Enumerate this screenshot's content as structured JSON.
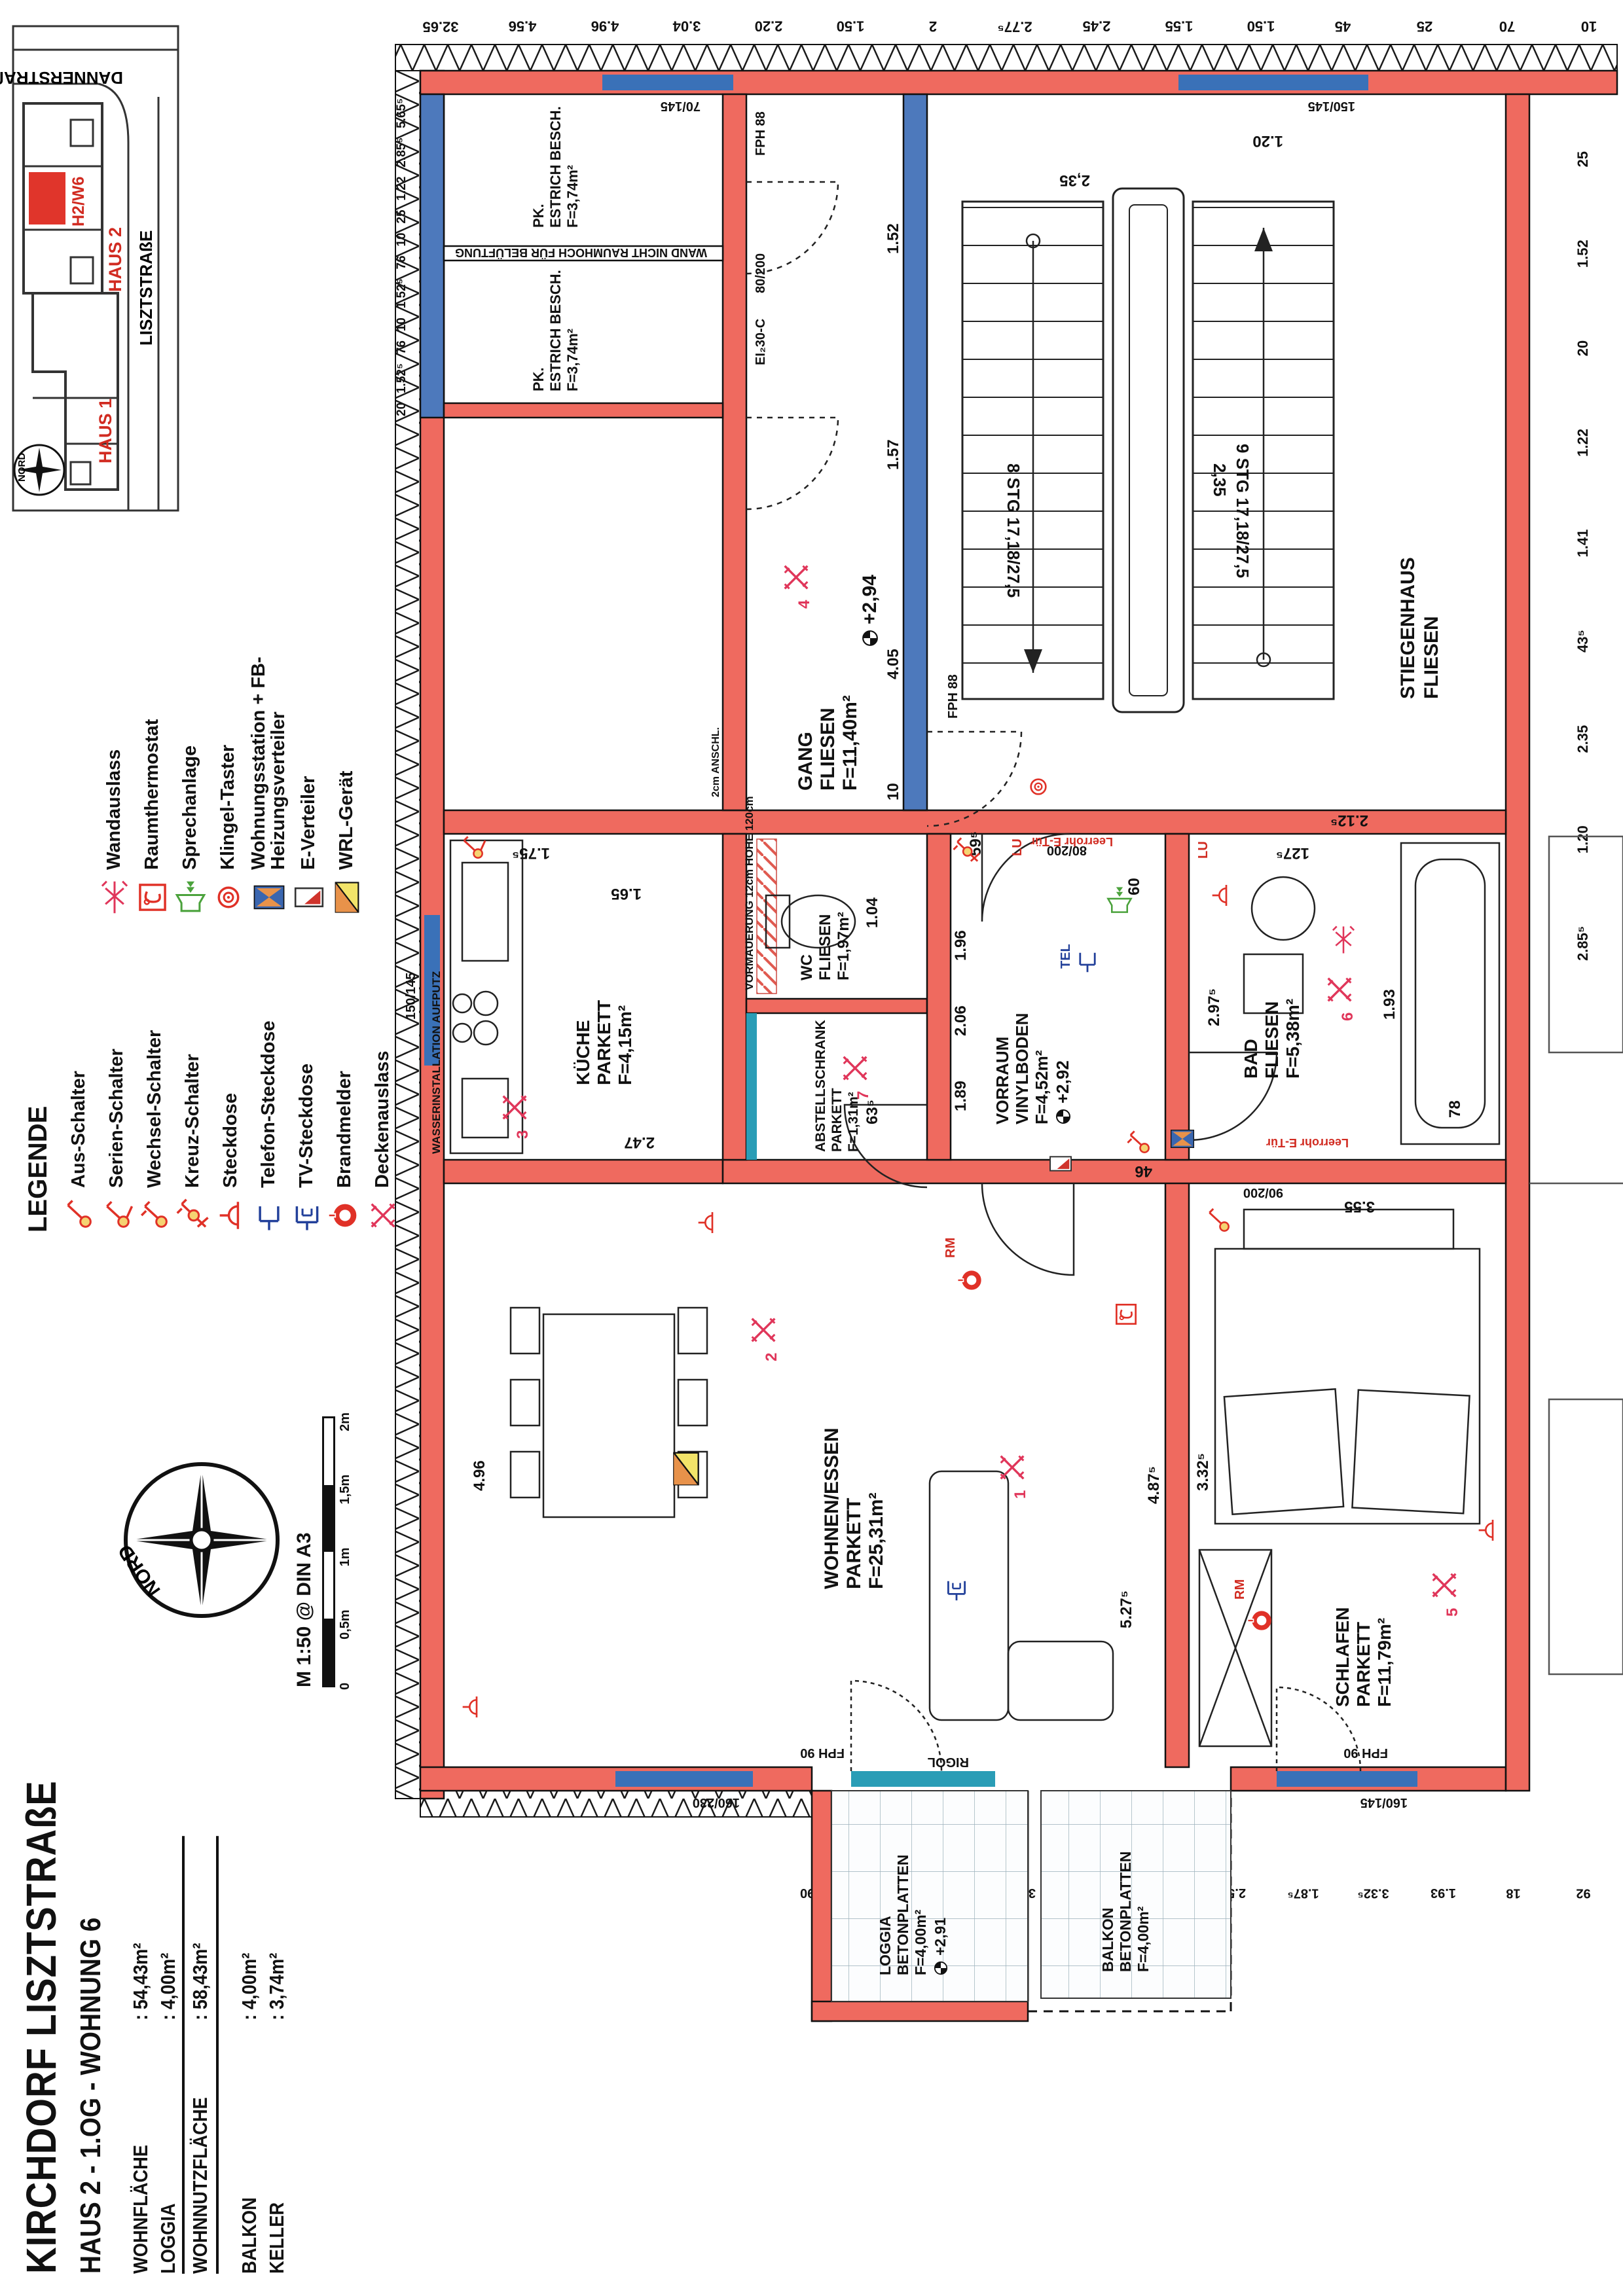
{
  "title_block": {
    "project": "KIRCHDORF LISZTSTRAßE",
    "unit_line": "HAUS 2 - 1.OG - WOHNUNG 6"
  },
  "area_table": {
    "rows": [
      {
        "label": "WOHNFLÄCHE",
        "value": ": 54,43m²"
      },
      {
        "label": "LOGGIA",
        "value": ": 4,00m²"
      },
      {
        "label": "WOHNNUTZFLÄCHE",
        "value": ": 58,43m²",
        "cls": "sum"
      },
      {
        "label": "BALKON",
        "value": ": 4,00m²",
        "cls": "gap"
      },
      {
        "label": "KELLER",
        "value": ": 3,74m²"
      }
    ]
  },
  "compass": {
    "label": "NORD"
  },
  "scalebar": {
    "label": "M 1:50 @ DIN A3",
    "ticks": [
      "0",
      "0,5m",
      "1m",
      "1,5m",
      "2m"
    ]
  },
  "site_plan": {
    "street_top": "DANNERSTRAßE",
    "street_bottom": "LISZTSTRAßE",
    "haus1": "HAUS 1",
    "haus2": "HAUS 2",
    "unit": "H2/W6",
    "nord": "NORD"
  },
  "legend": {
    "title": "LEGENDE",
    "col1": [
      {
        "icon": "switch-aus",
        "label": "Aus-Schalter"
      },
      {
        "icon": "switch-serien",
        "label": "Serien-Schalter"
      },
      {
        "icon": "switch-wechsel",
        "label": "Wechsel-Schalter"
      },
      {
        "icon": "switch-kreuz",
        "label": "Kreuz-Schalter"
      },
      {
        "icon": "steckdose",
        "label": "Steckdose"
      },
      {
        "icon": "telefon",
        "label": "Telefon-Steckdose"
      },
      {
        "icon": "tv",
        "label": "TV-Steckdose"
      },
      {
        "icon": "brandmelder",
        "label": "Brandmelder"
      },
      {
        "icon": "deckenauslass",
        "label": "Deckenauslass"
      }
    ],
    "col2": [
      {
        "icon": "wandauslass",
        "label": "Wandauslass"
      },
      {
        "icon": "raumthermostat",
        "label": "Raumthermostat"
      },
      {
        "icon": "sprechanlage",
        "label": "Sprechanlage"
      },
      {
        "icon": "klingel",
        "label": "Klingel-Taster"
      },
      {
        "icon": "wohnungsstation",
        "label": "Wohnungsstation + FB-Heizungsverteiler"
      },
      {
        "icon": "everteiler",
        "label": "E-Verteiler"
      },
      {
        "icon": "wrl",
        "label": "WRL-Gerät"
      }
    ]
  },
  "rooms": {
    "gang": {
      "name": "GANG",
      "floor": "FLIESEN",
      "area": "F=11,40m²",
      "level": "+2,94"
    },
    "stiegenhaus": {
      "name": "STIEGENHAUS",
      "floor": "FLIESEN"
    },
    "pk1": {
      "name": "PK.",
      "floor": "ESTRICH BESCH.",
      "area": "F=3,74m²"
    },
    "pk2": {
      "name": "PK.",
      "floor": "ESTRICH BESCH.",
      "area": "F=3,74m²"
    },
    "wc": {
      "name": "WC",
      "floor": "FLIESEN",
      "area": "F=1,97m²"
    },
    "abstell": {
      "name": "ABSTELLSCHRANK",
      "floor": "PARKETT",
      "area": "F=1,31m²"
    },
    "vorraum": {
      "name": "VORRAUM",
      "floor": "VINYLBODEN",
      "area": "F=4,52m²",
      "level": "+2,92"
    },
    "kueche": {
      "name": "KÜCHE",
      "floor": "PARKETT",
      "area": "F=4,15m²"
    },
    "wohnen": {
      "name": "WOHNEN/ESSEN",
      "floor": "PARKETT",
      "area": "F=25,31m²"
    },
    "schlafen": {
      "name": "SCHLAFEN",
      "floor": "PARKETT",
      "area": "F=11,79m²"
    },
    "bad": {
      "name": "BAD",
      "floor": "FLIESEN",
      "area": "F=5,38m²"
    },
    "loggia": {
      "name": "LOGGIA",
      "floor": "BETONPLATTEN",
      "area": "F=4,00m²",
      "level": "+2,91"
    },
    "balkon": {
      "name": "BALKON",
      "floor": "BETONPLATTEN",
      "area": "F=4,00m²"
    }
  },
  "stairs": {
    "flight_up": "8 STG 17,18/27,5",
    "flight_down": "9 STG 17,18/27,5",
    "width": "2,35"
  },
  "notes": {
    "vormauerung": "VORMAUERUNG 12cm HOHE 120cm",
    "wasser": "WASSERINSTALLATION AUFPUTZ",
    "wand": "WAND NICHT RAUMHOCH FÜR BELÜFTUNG",
    "rigol": "RIGOL",
    "leerrohr": "Leerrohr E-Tür",
    "anschl": "2cm ANSCHL."
  },
  "doors": {
    "fph88": "FPH 88",
    "fph90": "FPH 90",
    "ei30": "EI₂30-C",
    "d80": "80/200",
    "d90": "90/200"
  },
  "windows": {
    "w1": "70/145",
    "w2": "150/145",
    "w3": "160/230",
    "w4": "160/145"
  },
  "marks": {
    "tel": "TEL",
    "lu": "LU",
    "rm": "RM",
    "points": [
      "1",
      "2",
      "3",
      "4",
      "5",
      "6",
      "7"
    ]
  },
  "chains": {
    "right": [
      "32.65",
      "4.56",
      "4.96",
      "3.04",
      "2.20",
      "1.50",
      "2",
      "2.77⁵",
      "2.45",
      "1.55",
      "1.50",
      "45",
      "25",
      "70",
      "10"
    ],
    "top": [
      "20",
      "1.52⁵",
      "76",
      "10",
      "1.52⁵",
      "76",
      "10",
      "25",
      "1.22",
      "2.85⁵",
      "5.65⁵"
    ],
    "bottom": [
      "2.85⁵",
      "1.20",
      "2.35",
      "43⁵",
      "1.41",
      "1.22",
      "20",
      "1.52",
      "25",
      "5"
    ],
    "left": [
      "1.90",
      "1.60",
      "12",
      "3.37",
      "5",
      "3.20",
      "2.50",
      "1.87⁵",
      "3.32⁵",
      "1.93",
      "18",
      "92"
    ],
    "inner": [
      "4.05",
      "1.57",
      "1.52",
      "1.65",
      "1.75⁵",
      "2.47",
      "1.89",
      "2.06",
      "1.96",
      "1.04",
      "63⁵",
      "4.96",
      "4.87⁵",
      "5.27⁵",
      "3.32⁵",
      "3.55",
      "2.97⁵",
      "1.93",
      "2.12⁵",
      "78",
      "2,35",
      "1.20",
      "46",
      "59⁵",
      "127⁵",
      "10",
      "60"
    ]
  },
  "colors": {
    "wall": "#ef6a5f",
    "blue_wall": "#4d79bc",
    "window": "#3a71b8",
    "teal": "#2a9db6",
    "symbol_red": "#e03127",
    "symbol_pink": "#e0365a",
    "symbol_yellow": "#f5d372",
    "symbol_blue": "#22409a",
    "green": "#4ba23c",
    "label_red": "#d12b21",
    "wrl_orange": "#e8924a",
    "wrl_yellow": "#f2e469"
  }
}
